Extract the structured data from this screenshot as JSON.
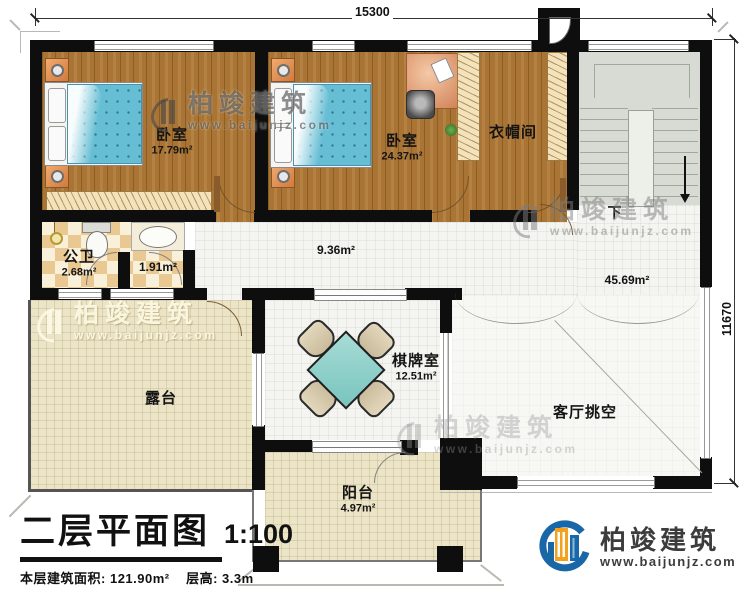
{
  "dimensions": {
    "top_width": "15300",
    "right_height": "11670"
  },
  "rooms": [
    {
      "id": "bedroom-1",
      "name": "卧室",
      "area": "17.79m²"
    },
    {
      "id": "bedroom-2",
      "name": "卧室",
      "area": "24.37m²"
    },
    {
      "id": "cloakroom",
      "name": "衣帽间",
      "area": ""
    },
    {
      "id": "public-bath",
      "name": "公卫",
      "area": "2.68m²"
    },
    {
      "id": "wash-area",
      "name": "",
      "area": "1.91m²"
    },
    {
      "id": "hallway",
      "name": "",
      "area": "9.36m²"
    },
    {
      "id": "open-area",
      "name": "",
      "area": "45.69m²"
    },
    {
      "id": "terrace",
      "name": "露台",
      "area": ""
    },
    {
      "id": "game-room",
      "name": "棋牌室",
      "area": "12.51m²"
    },
    {
      "id": "living-void",
      "name": "客厅挑空",
      "area": ""
    },
    {
      "id": "balcony",
      "name": "阳台",
      "area": "4.97m²"
    }
  ],
  "stairs": {
    "down_label": "下"
  },
  "watermark": {
    "name": "柏竣建筑",
    "website": "www.baijunjz.com"
  },
  "logo": {
    "name": "柏竣建筑",
    "website": "www.baijunjz.com"
  },
  "title_block": {
    "title": "二层平面图",
    "scale": "1:100",
    "area_label": "本层建筑面积:",
    "area_value": "121.90m²",
    "height_label": "层高:",
    "height_value": "3.3m"
  }
}
